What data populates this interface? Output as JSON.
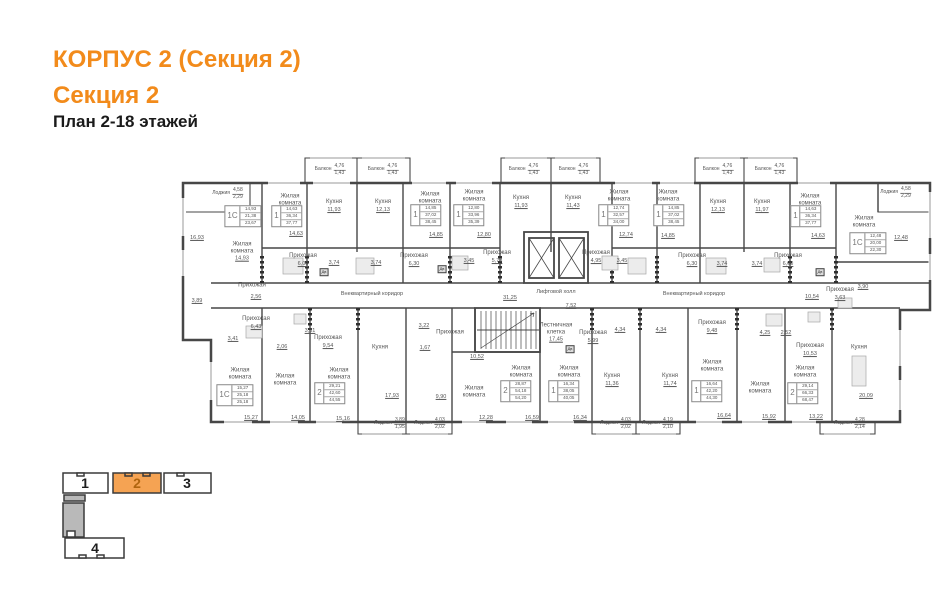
{
  "header": {
    "title1": "КОРПУС 2 (Секция 2)",
    "title2": "Секция 2",
    "subtitle": "План 2-18 этажей",
    "accent_color": "#F28B1B"
  },
  "minimap": {
    "active_fill": "#F5A353",
    "active_number_color": "#B0650F",
    "inactive_number_color": "#1E1E1E",
    "sections": [
      {
        "label": "1",
        "active": false
      },
      {
        "label": "2",
        "active": true
      },
      {
        "label": "3",
        "active": false
      },
      {
        "label": "4",
        "active": false
      }
    ]
  },
  "plan": {
    "labels": [
      {
        "k": "f",
        "t": "Лоджия",
        "a": "4,58",
        "b": "2,29",
        "x": 228,
        "y": 194
      },
      {
        "k": "f",
        "t": "Балкон",
        "a": "4,76",
        "b": "1,43",
        "x": 330,
        "y": 170
      },
      {
        "k": "f",
        "t": "Балкон",
        "a": "4,76",
        "b": "1,43",
        "x": 383,
        "y": 170
      },
      {
        "k": "f",
        "t": "Балкон",
        "a": "4,76",
        "b": "1,43",
        "x": 524,
        "y": 170
      },
      {
        "k": "f",
        "t": "Балкон",
        "a": "4,76",
        "b": "1,43",
        "x": 574,
        "y": 170
      },
      {
        "k": "f",
        "t": "Балкон",
        "a": "4,76",
        "b": "1,43",
        "x": 718,
        "y": 170
      },
      {
        "k": "f",
        "t": "Балкон",
        "a": "4,76",
        "b": "1,43",
        "x": 770,
        "y": 170
      },
      {
        "k": "f",
        "t": "Лоджия",
        "a": "4,58",
        "b": "2,29",
        "x": 896,
        "y": 193
      },
      {
        "k": "f",
        "t": "Лоджия",
        "a": "3,89",
        "b": "1,95",
        "x": 390,
        "y": 424
      },
      {
        "k": "f",
        "t": "Лоджия",
        "a": "4,03",
        "b": "2,02",
        "x": 430,
        "y": 424
      },
      {
        "k": "f",
        "t": "Лоджия",
        "a": "4,03",
        "b": "2,02",
        "x": 616,
        "y": 424
      },
      {
        "k": "f",
        "t": "Лоджия",
        "a": "4,19",
        "b": "2,10",
        "x": 658,
        "y": 424
      },
      {
        "k": "f",
        "t": "Лоджия",
        "a": "4,28",
        "b": "2,14",
        "x": 850,
        "y": 424
      },
      {
        "k": "r",
        "t": "Жилая комната",
        "x": 290,
        "y": 200
      },
      {
        "k": "r",
        "t": "Кухня",
        "v": "11,93",
        "x": 334,
        "y": 206
      },
      {
        "k": "r",
        "t": "Кухня",
        "v": "12,13",
        "x": 383,
        "y": 206
      },
      {
        "k": "r",
        "t": "Жилая комната",
        "x": 430,
        "y": 198
      },
      {
        "k": "r",
        "t": "Жилая комната",
        "x": 474,
        "y": 196
      },
      {
        "k": "r",
        "t": "Кухня",
        "v": "11,93",
        "x": 521,
        "y": 202
      },
      {
        "k": "r",
        "t": "Кухня",
        "v": "11,43",
        "x": 573,
        "y": 202
      },
      {
        "k": "r",
        "t": "Жилая комната",
        "x": 619,
        "y": 196
      },
      {
        "k": "r",
        "t": "Жилая комната",
        "x": 668,
        "y": 196
      },
      {
        "k": "r",
        "t": "Кухня",
        "v": "12,13",
        "x": 718,
        "y": 206
      },
      {
        "k": "r",
        "t": "Кухня",
        "v": "11,97",
        "x": 762,
        "y": 206
      },
      {
        "k": "r",
        "t": "Жилая комната",
        "x": 810,
        "y": 200
      },
      {
        "k": "r",
        "t": "Жилая комната",
        "x": 864,
        "y": 222
      },
      {
        "k": "r",
        "t": "Жилая комната",
        "v": "14,93",
        "x": 242,
        "y": 252
      },
      {
        "k": "r",
        "t": "Прихожая",
        "v": "6,00",
        "x": 303,
        "y": 260
      },
      {
        "k": "r",
        "t": "Прихожая",
        "v": "6,30",
        "x": 414,
        "y": 260
      },
      {
        "k": "r",
        "t": "Прихожая",
        "v": "5,78",
        "x": 497,
        "y": 257
      },
      {
        "k": "r",
        "t": "Прихожая",
        "v": "4,95",
        "x": 596,
        "y": 257
      },
      {
        "k": "r",
        "t": "Прихожая",
        "v": "6,30",
        "x": 692,
        "y": 260
      },
      {
        "k": "r",
        "t": "Прихожая",
        "v": "6,00",
        "x": 788,
        "y": 260
      },
      {
        "k": "r",
        "t": "Прихожая",
        "v": "3,63",
        "x": 840,
        "y": 294
      },
      {
        "k": "r",
        "t": "Прихожая",
        "x": 252,
        "y": 286
      },
      {
        "k": "r",
        "t": "Прихожая",
        "v": "6,43",
        "x": 256,
        "y": 323
      },
      {
        "k": "r",
        "t": "Прихожая",
        "v": "9,54",
        "x": 328,
        "y": 342
      },
      {
        "k": "r",
        "t": "Кухня",
        "x": 380,
        "y": 348
      },
      {
        "k": "r",
        "t": "Жилая комната",
        "x": 240,
        "y": 374
      },
      {
        "k": "r",
        "t": "Жилая комната",
        "x": 285,
        "y": 380
      },
      {
        "k": "r",
        "t": "Жилая комната",
        "x": 339,
        "y": 374
      },
      {
        "k": "r",
        "t": "Прихожая",
        "x": 450,
        "y": 333
      },
      {
        "k": "r",
        "t": "Жилая комната",
        "x": 474,
        "y": 392
      },
      {
        "k": "r",
        "t": "Прихожая",
        "v": "5,99",
        "x": 593,
        "y": 337
      },
      {
        "k": "r",
        "t": "Жилая комната",
        "x": 521,
        "y": 372
      },
      {
        "k": "r",
        "t": "Жилая комната",
        "x": 569,
        "y": 372
      },
      {
        "k": "r",
        "t": "Кухня",
        "v": "11,36",
        "x": 612,
        "y": 380
      },
      {
        "k": "r",
        "t": "Кухня",
        "v": "11,74",
        "x": 670,
        "y": 380
      },
      {
        "k": "r",
        "t": "Прихожая",
        "v": "9,48",
        "x": 712,
        "y": 327
      },
      {
        "k": "r",
        "t": "Прихожая",
        "v": "10,53",
        "x": 810,
        "y": 350
      },
      {
        "k": "r",
        "t": "Кухня",
        "x": 859,
        "y": 348
      },
      {
        "k": "r",
        "t": "Жилая комната",
        "x": 712,
        "y": 366
      },
      {
        "k": "r",
        "t": "Жилая комната",
        "x": 760,
        "y": 388
      },
      {
        "k": "r",
        "t": "Жилая комната",
        "x": 805,
        "y": 372
      },
      {
        "k": "r",
        "t": "Лестничная клетка",
        "v": "17,45",
        "x": 556,
        "y": 333
      },
      {
        "k": "c",
        "t": "Внеквартирный коридор",
        "x": 372,
        "y": 294
      },
      {
        "k": "c",
        "t": "Внеквартирный коридор",
        "x": 694,
        "y": 294
      },
      {
        "k": "c",
        "t": "Лифтовой холл",
        "x": 556,
        "y": 292
      },
      {
        "k": "d",
        "v": "14,63",
        "x": 296,
        "y": 234
      },
      {
        "k": "d",
        "v": "14,85",
        "x": 436,
        "y": 235
      },
      {
        "k": "d",
        "v": "12,80",
        "x": 484,
        "y": 235
      },
      {
        "k": "d",
        "v": "12,74",
        "x": 626,
        "y": 235
      },
      {
        "k": "d",
        "v": "14,85",
        "x": 668,
        "y": 236
      },
      {
        "k": "d",
        "v": "14,63",
        "x": 818,
        "y": 236
      },
      {
        "k": "d",
        "v": "12,48",
        "x": 901,
        "y": 238
      },
      {
        "k": "d",
        "v": "16,93",
        "x": 197,
        "y": 238
      },
      {
        "k": "d",
        "v": "3,74",
        "x": 334,
        "y": 263
      },
      {
        "k": "d",
        "v": "3,74",
        "x": 376,
        "y": 263
      },
      {
        "k": "d",
        "v": "3,45",
        "x": 469,
        "y": 261
      },
      {
        "k": "d",
        "v": "3,45",
        "x": 622,
        "y": 261
      },
      {
        "k": "d",
        "v": "3,74",
        "x": 722,
        "y": 264
      },
      {
        "k": "d",
        "v": "3,74",
        "x": 757,
        "y": 264
      },
      {
        "k": "d",
        "v": "3,90",
        "x": 863,
        "y": 287
      },
      {
        "k": "d",
        "v": "10,54",
        "x": 812,
        "y": 297
      },
      {
        "k": "d",
        "v": "31,25",
        "x": 510,
        "y": 298
      },
      {
        "k": "d",
        "v": "7,52",
        "x": 571,
        "y": 306
      },
      {
        "k": "d",
        "v": "3,89",
        "x": 197,
        "y": 301
      },
      {
        "k": "d",
        "v": "2,56",
        "x": 256,
        "y": 297
      },
      {
        "k": "d",
        "v": "3,41",
        "x": 233,
        "y": 339
      },
      {
        "k": "d",
        "v": "2,06",
        "x": 282,
        "y": 347
      },
      {
        "k": "d",
        "v": "3,81",
        "x": 310,
        "y": 331
      },
      {
        "k": "d",
        "v": "3,22",
        "x": 424,
        "y": 326
      },
      {
        "k": "d",
        "v": "1,67",
        "x": 425,
        "y": 348
      },
      {
        "k": "d",
        "v": "17,93",
        "x": 392,
        "y": 396
      },
      {
        "k": "d",
        "v": "20,09",
        "x": 866,
        "y": 396
      },
      {
        "k": "d",
        "v": "15,27",
        "x": 251,
        "y": 418
      },
      {
        "k": "d",
        "v": "14,05",
        "x": 298,
        "y": 418
      },
      {
        "k": "d",
        "v": "15,16",
        "x": 343,
        "y": 419
      },
      {
        "k": "d",
        "v": "10,52",
        "x": 477,
        "y": 357
      },
      {
        "k": "d",
        "v": "9,90",
        "x": 441,
        "y": 397
      },
      {
        "k": "d",
        "v": "12,28",
        "x": 486,
        "y": 418
      },
      {
        "k": "d",
        "v": "16,59",
        "x": 532,
        "y": 418
      },
      {
        "k": "d",
        "v": "16,34",
        "x": 580,
        "y": 418
      },
      {
        "k": "d",
        "v": "4,34",
        "x": 620,
        "y": 330
      },
      {
        "k": "d",
        "v": "4,34",
        "x": 661,
        "y": 330
      },
      {
        "k": "d",
        "v": "4,25",
        "x": 765,
        "y": 333
      },
      {
        "k": "d",
        "v": "2,52",
        "x": 786,
        "y": 333
      },
      {
        "k": "d",
        "v": "16,64",
        "x": 724,
        "y": 416
      },
      {
        "k": "d",
        "v": "15,92",
        "x": 769,
        "y": 417
      },
      {
        "k": "d",
        "v": "13,22",
        "x": 816,
        "y": 417
      },
      {
        "k": "s",
        "n": "1С",
        "v": [
          "14,93",
          "21,38",
          "23,67"
        ],
        "x": 243,
        "y": 216
      },
      {
        "k": "s",
        "n": "1",
        "v": [
          "14,63",
          "36,34",
          "37,77"
        ],
        "x": 287,
        "y": 216
      },
      {
        "k": "s",
        "n": "1",
        "v": [
          "14,85",
          "37,02",
          "38,45"
        ],
        "x": 426,
        "y": 215
      },
      {
        "k": "s",
        "n": "1",
        "v": [
          "12,80",
          "33,96",
          "35,39"
        ],
        "x": 469,
        "y": 215
      },
      {
        "k": "s",
        "n": "1",
        "v": [
          "12,74",
          "32,57",
          "34,00"
        ],
        "x": 614,
        "y": 215
      },
      {
        "k": "s",
        "n": "1",
        "v": [
          "14,85",
          "37,02",
          "38,45"
        ],
        "x": 669,
        "y": 215
      },
      {
        "k": "s",
        "n": "1",
        "v": [
          "14,63",
          "36,34",
          "37,77"
        ],
        "x": 806,
        "y": 216
      },
      {
        "k": "s",
        "n": "1С",
        "v": [
          "12,48",
          "20,00",
          "22,30"
        ],
        "x": 868,
        "y": 243
      },
      {
        "k": "s",
        "n": "1С",
        "v": [
          "15,27",
          "25,18",
          "25,18"
        ],
        "x": 235,
        "y": 395
      },
      {
        "k": "s",
        "n": "2",
        "v": [
          "29,21",
          "42,60",
          "44,55"
        ],
        "x": 330,
        "y": 393
      },
      {
        "k": "s",
        "n": "2",
        "v": [
          "28,87",
          "54,18",
          "54,20"
        ],
        "x": 516,
        "y": 391
      },
      {
        "k": "s",
        "n": "1",
        "v": [
          "16,34",
          "38,05",
          "40,05"
        ],
        "x": 564,
        "y": 391
      },
      {
        "k": "s",
        "n": "1",
        "v": [
          "16,64",
          "42,20",
          "44,30"
        ],
        "x": 707,
        "y": 391
      },
      {
        "k": "s",
        "n": "2",
        "v": [
          "29,14",
          "66,33",
          "68,47"
        ],
        "x": 803,
        "y": 393
      },
      {
        "k": "door",
        "t": "Дв",
        "x": 324,
        "y": 272
      },
      {
        "k": "door",
        "t": "Дв",
        "x": 442,
        "y": 269
      },
      {
        "k": "door",
        "t": "Дв",
        "x": 820,
        "y": 272
      },
      {
        "k": "door",
        "t": "Дв",
        "x": 570,
        "y": 349
      }
    ]
  }
}
